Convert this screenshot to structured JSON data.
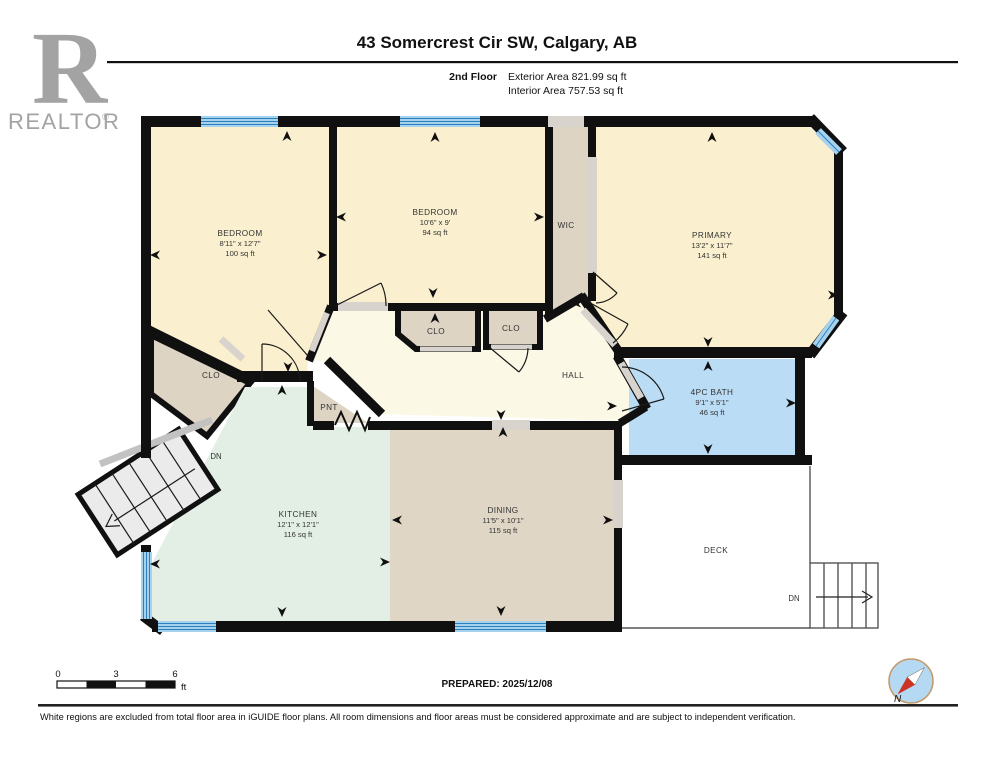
{
  "header": {
    "title": "43 Somercrest Cir SW, Calgary, AB",
    "floor_label": "2nd Floor",
    "exterior_area": "Exterior Area 821.99 sq ft",
    "interior_area": "Interior Area 757.53 sq ft"
  },
  "logo": {
    "letter": "R",
    "brand": "REALTOR",
    "registered": "®"
  },
  "rooms": {
    "bedroom_left": {
      "name": "BEDROOM",
      "dims": "8'11\" x 12'7\"",
      "area": "100 sq ft"
    },
    "bedroom_middle": {
      "name": "BEDROOM",
      "dims": "10'6\" x 9'",
      "area": "94 sq ft"
    },
    "primary": {
      "name": "PRIMARY",
      "dims": "13'2\" x 11'7\"",
      "area": "141 sq ft"
    },
    "bath": {
      "name": "4PC BATH",
      "dims": "9'1\" x 5'1\"",
      "area": "46 sq ft"
    },
    "kitchen": {
      "name": "KITCHEN",
      "dims": "12'1\" x 12'1\"",
      "area": "116 sq ft"
    },
    "dining": {
      "name": "DINING",
      "dims": "11'5\" x 10'1\"",
      "area": "115 sq ft"
    },
    "wic": {
      "name": "WIC"
    },
    "hall": {
      "name": "HALL"
    },
    "pantry": {
      "name": "PNT"
    },
    "closet_left": {
      "name": "CLO"
    },
    "closet_mid": {
      "name": "CLO"
    },
    "closet_right": {
      "name": "CLO"
    },
    "deck": {
      "name": "DECK"
    }
  },
  "stairs": {
    "down_interior": "DN",
    "down_exterior": "DN"
  },
  "scale_bar": {
    "t0": "0",
    "t3": "3",
    "t6": "6",
    "unit": "ft"
  },
  "compass": {
    "north_label": "N"
  },
  "footer": {
    "prepared": "PREPARED: 2025/12/08",
    "disclaimer": "White regions are excluded from total floor area in iGUIDE floor plans. All room dimensions and floor areas must be considered approximate and are subject to independent verification."
  },
  "colors": {
    "wall": "#101010",
    "window_blue": "#A6D2EE",
    "window_stripe": "#2B7FBC",
    "opening_gray": "#D8D4CD",
    "bedroom_fill": "#FAEFCE",
    "hall_fill": "#FCF8E6",
    "tan_fill": "#DED4C4",
    "kitchen_fill": "#E3EFE4",
    "bath_fill": "#BBDCF5",
    "deck_fill": "#FFFFFF",
    "logo_gray": "#A3A3A3",
    "compass_ring": "#C49A6C",
    "compass_fill": "#B5D9F2",
    "needle_red": "#CC3322"
  }
}
